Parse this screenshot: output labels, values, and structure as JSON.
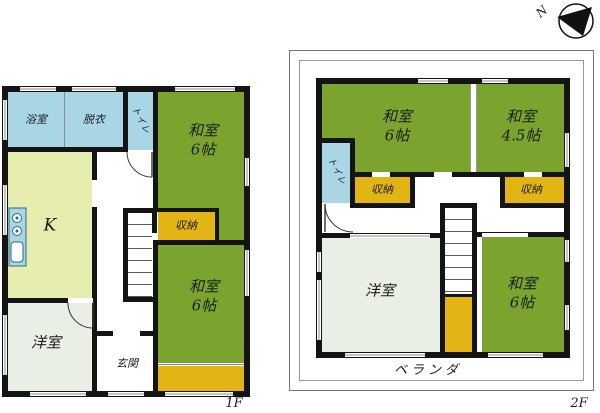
{
  "palette": {
    "wall": "#141414",
    "washitsu_green": "#7aa42d",
    "closet_yellow": "#e2b414",
    "water_blue": "#a9d6e5",
    "kitchen_yellow_green": "#e7edae",
    "western_room_gray": "#e9efe4",
    "thin_line": "#777777",
    "background": "#ffffff"
  },
  "compass": {
    "label": "N"
  },
  "floor1": {
    "floor_label": "1F",
    "rooms": {
      "bath": "浴室",
      "dressing": "脱衣",
      "toilet": "トイレ",
      "washitsu_upper": {
        "name": "和室",
        "size": "6帖"
      },
      "closet_upper": "収納",
      "washitsu_lower": {
        "name": "和室",
        "size": "6帖"
      },
      "kitchen": "K",
      "western_room": "洋室",
      "entrance": "玄関"
    }
  },
  "floor2": {
    "floor_label": "2F",
    "veranda": "ベランダ",
    "rooms": {
      "washitsu_nw": {
        "name": "和室",
        "size": "6帖"
      },
      "washitsu_ne": {
        "name": "和室",
        "size": "4.5帖"
      },
      "toilet": "トイレ",
      "closet_west": "収納",
      "closet_east": "収納",
      "western_room": "洋室",
      "washitsu_se": {
        "name": "和室",
        "size": "6帖"
      }
    }
  }
}
